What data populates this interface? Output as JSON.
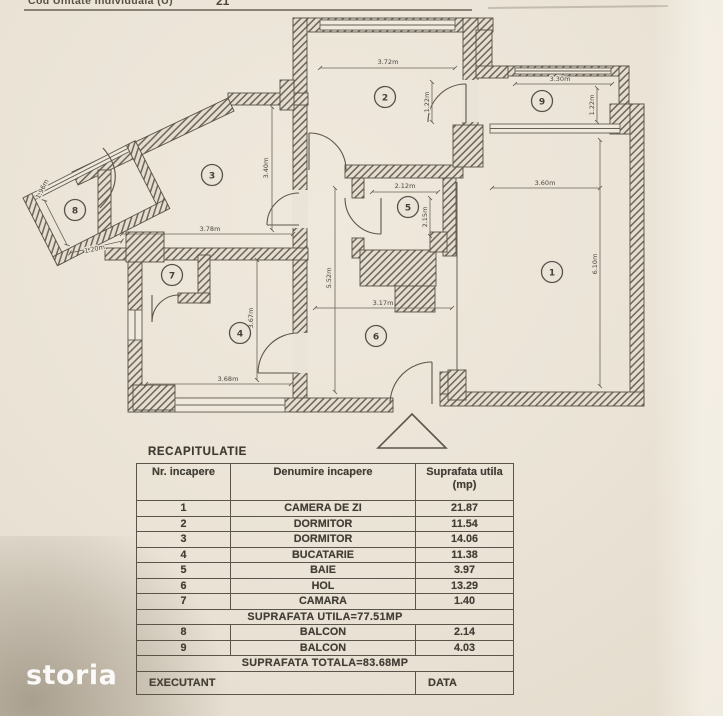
{
  "page": {
    "header_note": "Cod Unitate Individuala (U)",
    "header_partial": "21",
    "watermark": "storia"
  },
  "colors": {
    "paper": "#eae3d7",
    "ink": "#46413a",
    "wall_hatch": "#6e6759",
    "watermark_white": "#ffffff"
  },
  "plan": {
    "entrance_symbol": "triangle-arrow",
    "room_labels": [
      {
        "n": "1",
        "x": 552,
        "y": 272
      },
      {
        "n": "2",
        "x": 385,
        "y": 97
      },
      {
        "n": "3",
        "x": 212,
        "y": 175
      },
      {
        "n": "4",
        "x": 240,
        "y": 333
      },
      {
        "n": "5",
        "x": 408,
        "y": 207
      },
      {
        "n": "6",
        "x": 376,
        "y": 336
      },
      {
        "n": "7",
        "x": 172,
        "y": 275
      },
      {
        "n": "8",
        "x": 75,
        "y": 210
      },
      {
        "n": "9",
        "x": 542,
        "y": 101
      }
    ],
    "dimensions": [
      {
        "t": "3.72m",
        "x": 388,
        "y": 64,
        "r": 0
      },
      {
        "t": "1.22m",
        "x": 429,
        "y": 102,
        "r": -90
      },
      {
        "t": "3.30m",
        "x": 560,
        "y": 81,
        "r": 0
      },
      {
        "t": "1.22m",
        "x": 594,
        "y": 105,
        "r": -90
      },
      {
        "t": "3.60m",
        "x": 545,
        "y": 185,
        "r": 0
      },
      {
        "t": "6.10m",
        "x": 597,
        "y": 264,
        "r": -90
      },
      {
        "t": "2.12m",
        "x": 405,
        "y": 188,
        "r": 0
      },
      {
        "t": "2.15m",
        "x": 427,
        "y": 217,
        "r": -90
      },
      {
        "t": "3.17m",
        "x": 383,
        "y": 305,
        "r": 0
      },
      {
        "t": "5.52m",
        "x": 331,
        "y": 278,
        "r": -90
      },
      {
        "t": "3.40m",
        "x": 268,
        "y": 168,
        "r": -90
      },
      {
        "t": "3.78m",
        "x": 210,
        "y": 231,
        "r": 0
      },
      {
        "t": "3.68m",
        "x": 228,
        "y": 381,
        "r": 0
      },
      {
        "t": "3.67m",
        "x": 253,
        "y": 318,
        "r": -90
      },
      {
        "t": "1.96m",
        "x": 44,
        "y": 190,
        "r": -63
      },
      {
        "t": "1.20m",
        "x": 95,
        "y": 251,
        "r": -12
      }
    ]
  },
  "recap": {
    "title": "RECAPITULATIE",
    "columns": [
      "Nr. incapere",
      "Denumire incapere",
      "Suprafata utila",
      "(mp)"
    ],
    "rows": [
      {
        "nr": "1",
        "name": "CAMERA DE ZI",
        "area": "21.87"
      },
      {
        "nr": "2",
        "name": "DORMITOR",
        "area": "11.54"
      },
      {
        "nr": "3",
        "name": "DORMITOR",
        "area": "14.06"
      },
      {
        "nr": "4",
        "name": "BUCATARIE",
        "area": "11.38"
      },
      {
        "nr": "5",
        "name": "BAIE",
        "area": "3.97"
      },
      {
        "nr": "6",
        "name": "HOL",
        "area": "13.29"
      },
      {
        "nr": "7",
        "name": "CAMARA",
        "area": "1.40"
      }
    ],
    "subtotal": "SUPRAFATA UTILA=77.51MP",
    "balcony_rows": [
      {
        "nr": "8",
        "name": "BALCON",
        "area": "2.14"
      },
      {
        "nr": "9",
        "name": "BALCON",
        "area": "4.03"
      }
    ],
    "total": "SUPRAFATA TOTALA=83.68MP",
    "footer": {
      "executant": "EXECUTANT",
      "data": "DATA"
    }
  }
}
